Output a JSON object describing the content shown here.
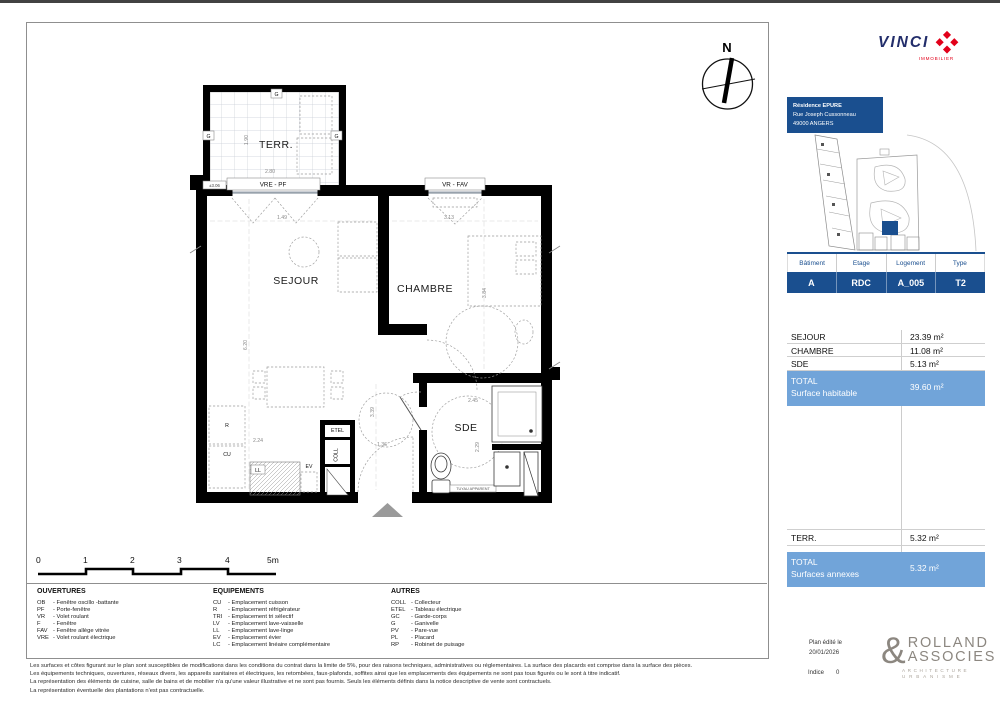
{
  "page": {
    "compass_n": "N"
  },
  "vinci": {
    "wordmark": "VINCI",
    "subtitle": "IMMOBILIER"
  },
  "project": {
    "line1": "Résidence EPURE",
    "line2": "Rue Joseph Cussonneau",
    "line3": "49000 ANGERS"
  },
  "unit": {
    "headers": [
      "Bâtiment",
      "Etage",
      "Logement",
      "Type"
    ],
    "values": [
      "A",
      "RDC",
      "A_005",
      "T2"
    ]
  },
  "surfaces": {
    "rows": [
      {
        "label": "SEJOUR",
        "value": "23.39 m²"
      },
      {
        "label": "CHAMBRE",
        "value": "11.08 m²"
      },
      {
        "label": "SDE",
        "value": "5.13 m²"
      }
    ],
    "total_habitable": {
      "title": "TOTAL",
      "subtitle": "Surface habitable",
      "value": "39.60 m²"
    },
    "annexes": [
      {
        "label": "TERR.",
        "value": "5.32 m²"
      }
    ],
    "total_annexes": {
      "title": "TOTAL",
      "subtitle": "Surfaces annexes",
      "value": "5.32 m²"
    }
  },
  "plan": {
    "rooms": {
      "terrasse": "TERR.",
      "sejour": "SEJOUR",
      "chambre": "CHAMBRE",
      "sde": "SDE"
    },
    "windows": {
      "w1": "VRE - PF",
      "w2": "VR - FAV",
      "level": "±3.06"
    },
    "marks": {
      "etel": "ETEL",
      "coll": "COLL",
      "r": "R",
      "cu": "CU",
      "ll": "LL",
      "ev": "EV",
      "g": "G",
      "tuyau": "TUYAU APPARENT"
    },
    "dims": {
      "sejour_w": "1.49",
      "chambre_w": "3.13",
      "sejour_h": "6.20",
      "chambre_h": "3.84",
      "hall_h": "3.39",
      "hall_w": "1.36",
      "kitchen_w": "2.24",
      "sde_w": "2.45",
      "sde_h": "2.29",
      "terr_h": "1.90",
      "terr_w": "2.80"
    }
  },
  "scalebar": {
    "labels": [
      "0",
      "1",
      "2",
      "3",
      "4",
      "5m"
    ]
  },
  "legend": {
    "ouvertures": {
      "title": "OUVERTURES",
      "items": [
        {
          "code": "OB",
          "desc": "Fenêtre oscillo -battante"
        },
        {
          "code": "PF",
          "desc": "Porte-fenêtre"
        },
        {
          "code": "VR",
          "desc": "Volet roulant"
        },
        {
          "code": "F",
          "desc": "Fenêtre"
        },
        {
          "code": "FAV",
          "desc": "Fenêtre allège vitrée"
        },
        {
          "code": "VRE",
          "desc": "Volet roulant électrique"
        }
      ]
    },
    "equipements": {
      "title": "EQUIPEMENTS",
      "items": [
        {
          "code": "CU",
          "desc": "Emplacement cuisson"
        },
        {
          "code": "R",
          "desc": "Emplacement réfrigérateur"
        },
        {
          "code": "TRI",
          "desc": "Emplacement tri sélectif"
        },
        {
          "code": "LV",
          "desc": "Emplacement lave-vaisselle"
        },
        {
          "code": "LL",
          "desc": "Emplacement lave-linge"
        },
        {
          "code": "EV",
          "desc": "Emplacement évier"
        },
        {
          "code": "LC",
          "desc": "Emplacement linéaire complémentaire"
        }
      ]
    },
    "autres": {
      "title": "AUTRES",
      "items": [
        {
          "code": "COLL",
          "desc": "Collecteur"
        },
        {
          "code": "ETEL",
          "desc": "Tableau électrique"
        },
        {
          "code": "GC",
          "desc": "Garde-corps"
        },
        {
          "code": "G",
          "desc": "Ganivelle"
        },
        {
          "code": "PV",
          "desc": "Pare-vue"
        },
        {
          "code": "PL",
          "desc": "Placard"
        },
        {
          "code": "RP",
          "desc": "Robinet de puisage"
        }
      ]
    }
  },
  "footer": {
    "disclaimers": [
      "Les surfaces et côtes figurant sur le plan sont susceptibles de modifications dans les conditions du contrat dans la limite de 5%, pour des raisons techniques, administratives ou réglementaires. La surface des placards est comprise dans la surface des pièces.",
      "Les équipements techniques, ouvertures, réseaux divers, les appareils sanitaires et électriques, les retombées, faux-plafonds, soffites ainsi que les emplacements des équipements ne sont pas tous figurés ou le sont à titre indicatif.",
      "La représentation des éléments de cuisine, salle de bains et de mobilier n'a qu'une valeur illustrative et ne sont pas fournis. Seuls les éléments définis dans la notice descriptive de vente sont contractuels.",
      "La représentation éventuelle des plantations n'est pas contractuelle."
    ],
    "edited_label": "Plan édité le",
    "edited_date": "20/01/2026",
    "indice_label": "Indice",
    "indice_value": "0"
  },
  "architect": {
    "amp": "&",
    "name1": "ROLLAND",
    "name2": "ASSOCIES",
    "field1": "ARCHITECTURE",
    "field2": "URBANISME"
  },
  "colors": {
    "dark_blue": "#1a4f8f",
    "light_blue": "#71a4d9",
    "vinci_navy": "#232e6b",
    "vinci_red": "#e2001a"
  }
}
